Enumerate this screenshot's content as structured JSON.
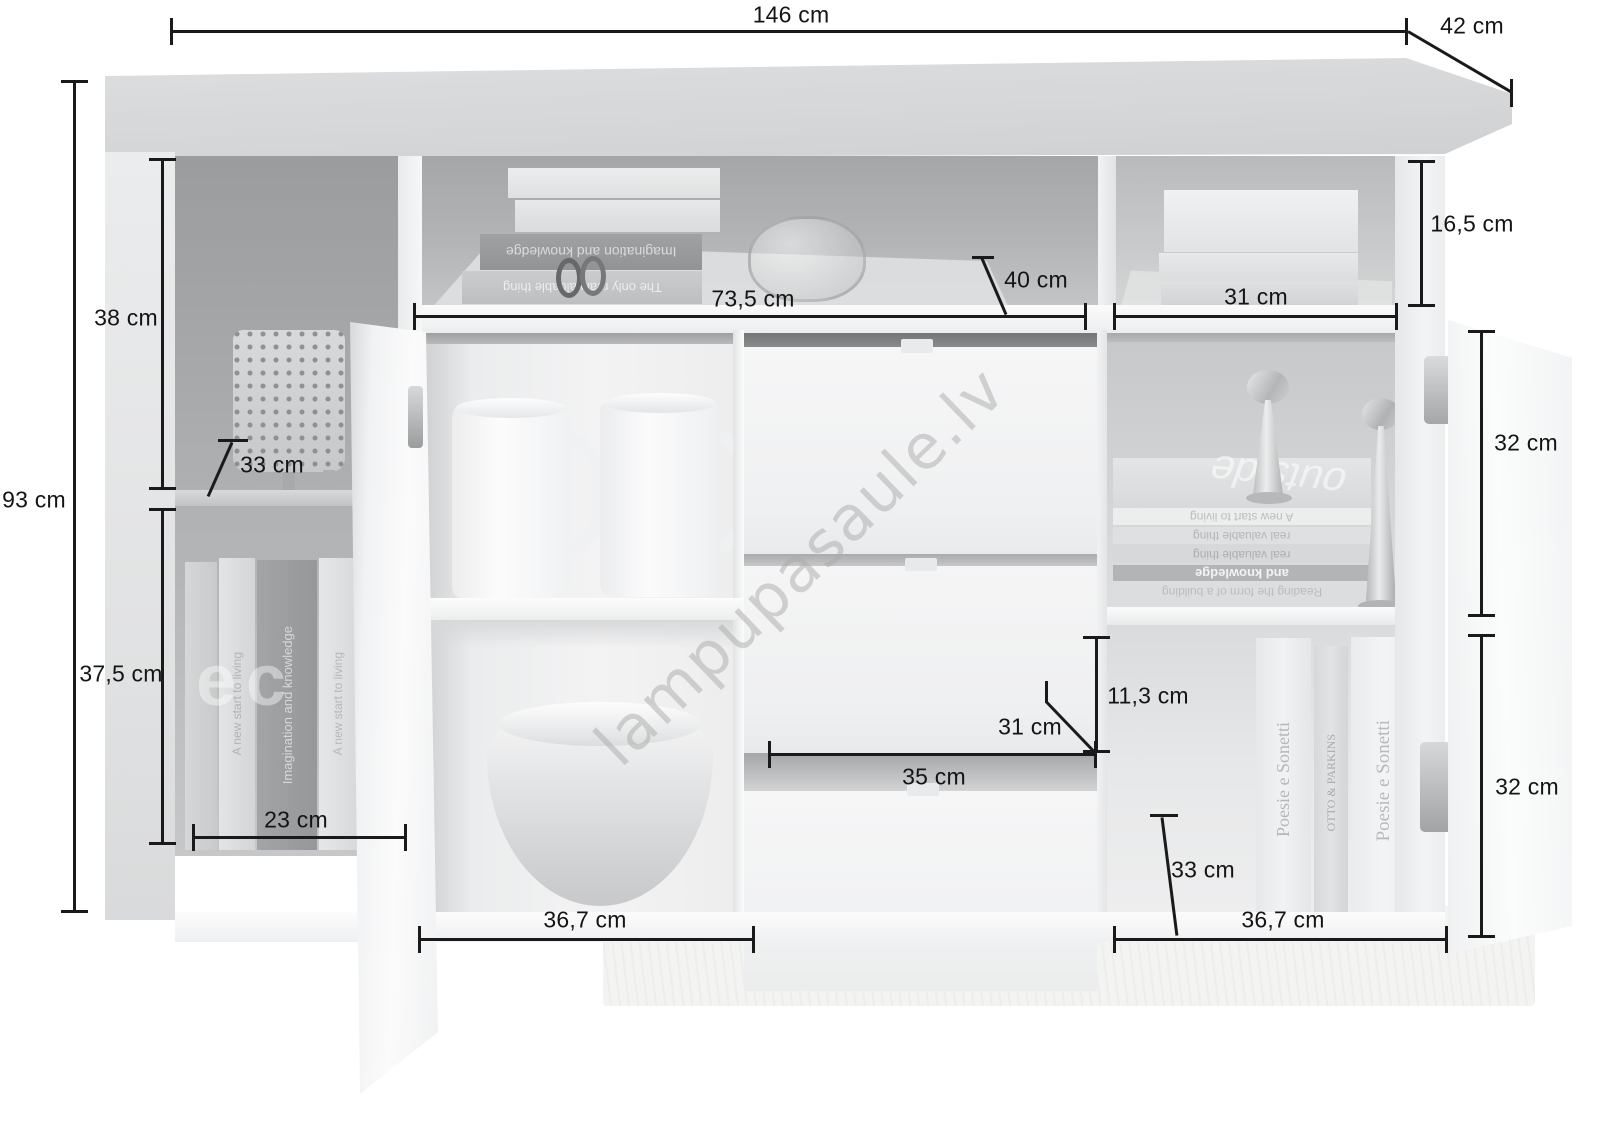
{
  "watermark": {
    "text": "lampupasaule.lv"
  },
  "dimensions": {
    "total_width": "146 cm",
    "total_depth": "42 cm",
    "total_height": "93 cm",
    "upper_left_height": "38 cm",
    "left_shelf_depth": "33 cm",
    "lower_left_height": "37,5 cm",
    "left_interior_width": "23 cm",
    "top_shelf_height": "16,5 cm",
    "middle_width": "73,5 cm",
    "middle_shelf_depth": "40 cm",
    "right_top_width": "31 cm",
    "upper_right_height": "32 cm",
    "drawer_front_height": "11,3 cm",
    "drawer_inner_width": "31 cm",
    "drawer_width": "35 cm",
    "right_shelf_depth": "33 cm",
    "bottom_left_width": "36,7 cm",
    "bottom_right_width": "36,7 cm",
    "lower_right_height": "32 cm"
  },
  "books": {
    "top_niche_dark_spine": "Imagination and knowledge",
    "top_niche_light_spine": "The only real valuable thing",
    "left_comp_spine_1": "A new start to living",
    "left_comp_spine_2": "Imagination and knowledge",
    "left_comp_spine_3": "A new start to living",
    "left_comp_overlay": "ec",
    "right_stack_cover": "outside",
    "right_stack_spine_1": "A new start to living",
    "right_stack_spine_2": "real valuable thing",
    "right_stack_spine_3": "real valuable thing",
    "right_stack_spine_4": "and knowledge",
    "right_stack_spine_5": "Reading the form of a building",
    "right_vertical_1": "Poesie e Sonetti",
    "right_vertical_2": "OTTO & PARKINS",
    "right_vertical_3": "Poesie e Sonetti"
  },
  "colors": {
    "dimension_line": "#1a1a1a",
    "watermark_gray": "#aaaaaa",
    "metal_silver": "#c2c3c5",
    "cabinet_top": "#d7d8da",
    "interior_dark": "#a4a5a7"
  }
}
